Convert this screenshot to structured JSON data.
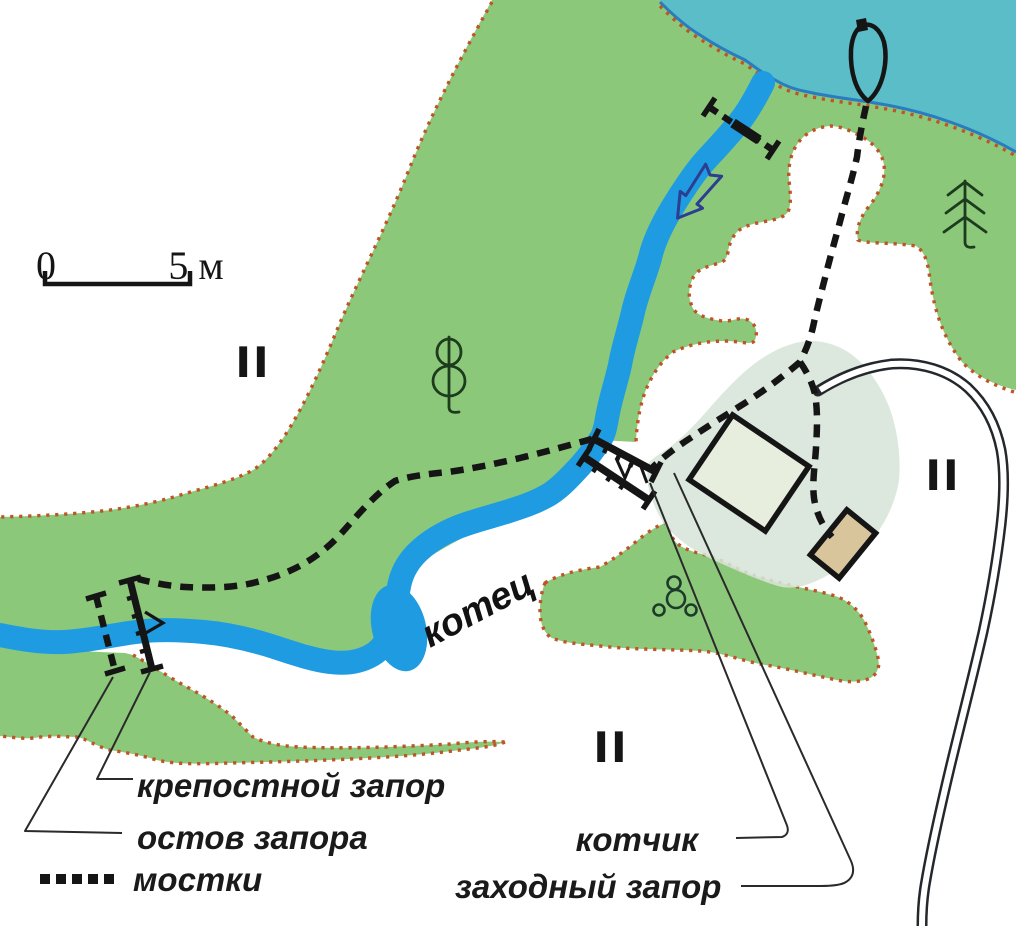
{
  "map": {
    "scale_bar": {
      "start": "0",
      "end": "5 м"
    },
    "zone_markers": {
      "left": "II",
      "right": "II",
      "bottom": "II"
    },
    "water_label": "котец",
    "callouts": {
      "kotchik": "котчик",
      "zakhodny": "заходный запор"
    },
    "legend": {
      "krepostnoy": "крепостной запор",
      "ostov": "остов запора",
      "mostki": "мостки"
    },
    "colors": {
      "land_green": "#8cc87a",
      "lake_teal": "#5abdc7",
      "river_blue": "#1f9ce1",
      "shoreline_blue": "#2a7cc0",
      "border_dots_orange": "#bf5426",
      "homestead_area": "#d7e5d8",
      "big_building_fill": "#e7eede",
      "small_building_fill": "#d8c59c",
      "flow_arrow_blue": "#2b3e92",
      "ink_black": "#151515"
    },
    "icons": [
      "boat-icon",
      "spruce-tree-icon",
      "deciduous-tree-icon",
      "flow-arrow-icon",
      "weir-barrier-icon",
      "stones-icon",
      "walkway-dashes-icon"
    ]
  }
}
